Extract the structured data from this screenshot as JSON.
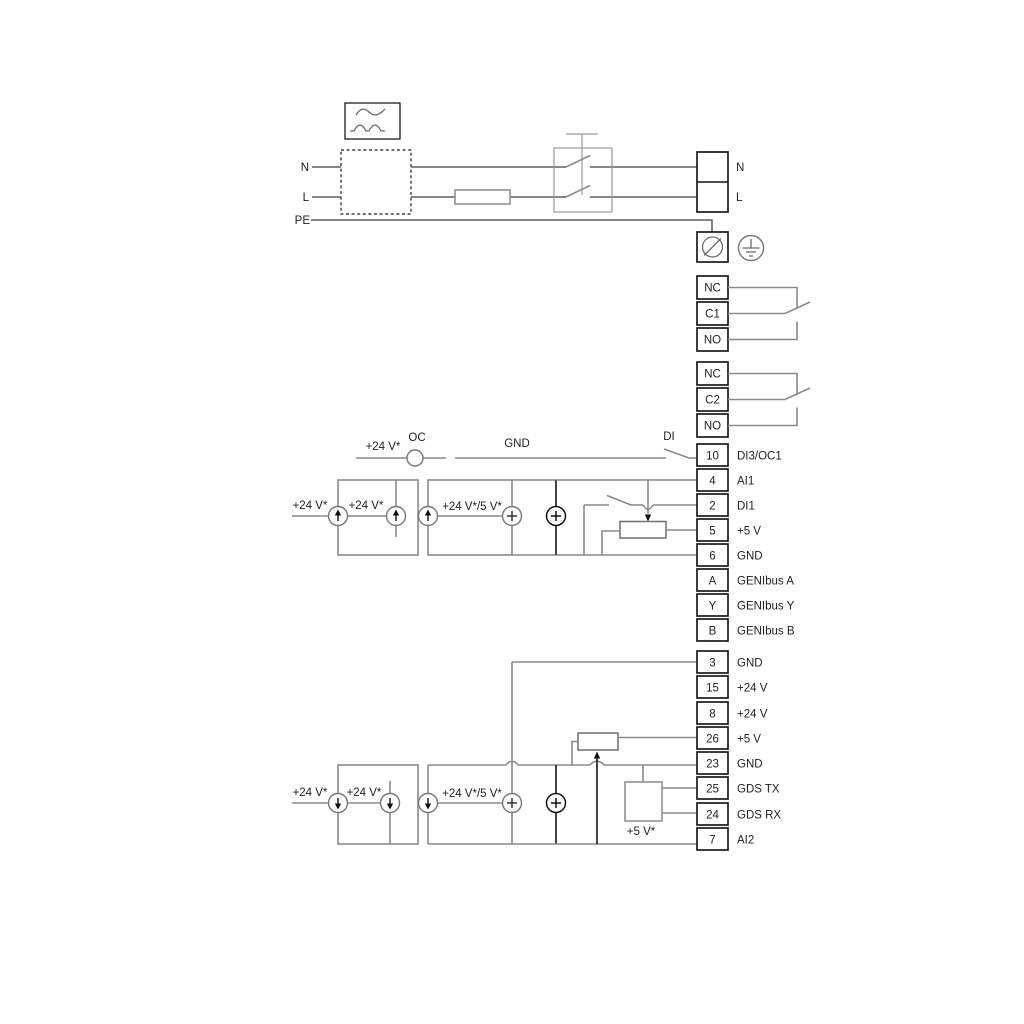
{
  "colors": {
    "wire_gray": "#8a8a8a",
    "line_black": "#1a1a1a",
    "text": "#1f1f1f",
    "background": "#ffffff"
  },
  "power": {
    "n_left": "N",
    "l_left": "L",
    "pe": "PE",
    "n_right": "N",
    "l_right": "L"
  },
  "relay1": {
    "nc": "NC",
    "c": "C1",
    "no": "NO"
  },
  "relay2": {
    "nc": "NC",
    "c": "C2",
    "no": "NO"
  },
  "oc_row": {
    "v24": "+24 V*",
    "oc": "OC",
    "gnd": "GND",
    "di": "DI"
  },
  "upper_block": {
    "src_ext": "+24 V*",
    "src_int": "+24 V*",
    "src_dual": "+24 V*/5 V*"
  },
  "lower_block": {
    "src_ext": "+24 V*",
    "src_int": "+24 V*",
    "src_dual": "+24 V*/5 V*",
    "v5": "+5 V*"
  },
  "strip1": {
    "rows": [
      {
        "pin": "10",
        "label": "DI3/OC1"
      },
      {
        "pin": "4",
        "label": "AI1"
      },
      {
        "pin": "2",
        "label": "DI1"
      },
      {
        "pin": "5",
        "label": "+5 V"
      },
      {
        "pin": "6",
        "label": "GND"
      },
      {
        "pin": "A",
        "label": "GENIbus A"
      },
      {
        "pin": "Y",
        "label": "GENIbus Y"
      },
      {
        "pin": "B",
        "label": "GENIbus B"
      }
    ]
  },
  "strip2": {
    "rows": [
      {
        "pin": "3",
        "label": "GND"
      },
      {
        "pin": "15",
        "label": "+24 V"
      },
      {
        "pin": "8",
        "label": "+24 V"
      },
      {
        "pin": "26",
        "label": "+5 V"
      },
      {
        "pin": "23",
        "label": "GND"
      },
      {
        "pin": "25",
        "label": "GDS TX"
      },
      {
        "pin": "24",
        "label": "GDS RX"
      },
      {
        "pin": "7",
        "label": "AI2"
      }
    ]
  }
}
